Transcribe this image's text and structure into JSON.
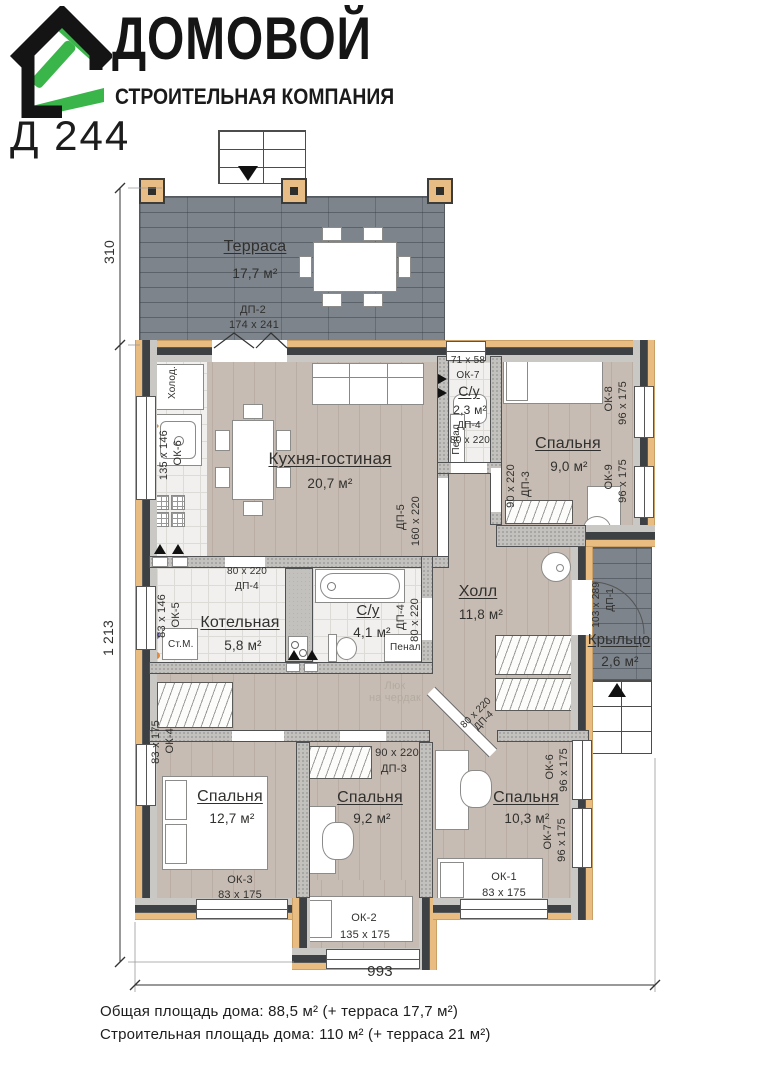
{
  "header": {
    "brand": "ДОМОВОЙ",
    "subtitle": "СТРОИТЕЛЬНАЯ КОМПАНИЯ",
    "model": "Д 244"
  },
  "colors": {
    "logo_green": "#3ab54a",
    "wall_dark": "#3e4144",
    "insulation": "#e9bd82",
    "terrace_tile": "#7d848c",
    "wood_floor": "#c7bcb3"
  },
  "dimensions": {
    "terrace_depth": "310",
    "house_depth": "1 213",
    "house_width": "993"
  },
  "rooms": {
    "terrace": {
      "name": "Терраса",
      "area": "17,7 м²"
    },
    "kitchen": {
      "name": "Кухня-гостиная",
      "area": "20,7 м²"
    },
    "wc": {
      "name": "С/у",
      "area": "2,3 м²"
    },
    "bedroom_tr": {
      "name": "Спальня",
      "area": "9,0 м²"
    },
    "boiler": {
      "name": "Котельная",
      "area": "5,8 м²"
    },
    "bath": {
      "name": "С/у",
      "area": "4,1 м²"
    },
    "hall": {
      "name": "Холл",
      "area": "11,8 м²"
    },
    "porch": {
      "name": "Крыльцо",
      "area": "2,6 м²"
    },
    "bedroom_bl": {
      "name": "Спальня",
      "area": "12,7 м²"
    },
    "bedroom_bm": {
      "name": "Спальня",
      "area": "9,2 м²"
    },
    "bedroom_br": {
      "name": "Спальня",
      "area": "10,3 м²"
    }
  },
  "openings": {
    "dp2": {
      "id": "ДП-2",
      "size": "174 х 241"
    },
    "dp5": {
      "id": "ДП-5",
      "size": "160 х 220"
    },
    "dp4_wc": {
      "id": "ДП-4",
      "size": "80 х 220"
    },
    "dp4_boiler": {
      "id": "ДП-4",
      "size": "80 х 220"
    },
    "dp4_bath": {
      "id": "ДП-4",
      "size": "80 х 220"
    },
    "dp4_br": {
      "id": "ДП-4",
      "size": "80 х 220"
    },
    "dp3_tr": {
      "id": "ДП-3",
      "size": "90 х 220"
    },
    "dp3_bm": {
      "id": "ДП-3",
      "size": "90 х 220"
    },
    "dp1": {
      "id": "ДП-1",
      "size": "103 х 289"
    },
    "ok7_wc": {
      "id": "ОК-7",
      "size": "71 х 58"
    },
    "ok6_k": {
      "id": "ОК-6",
      "size": "135 х 146"
    },
    "ok5": {
      "id": "ОК-5",
      "size": "83 х 146"
    },
    "ok4": {
      "id": "ОК-4",
      "size": "83 х 175"
    },
    "ok3": {
      "id": "ОК-3",
      "size": "83 х 175"
    },
    "ok2": {
      "id": "ОК-2",
      "size": "135 х 175"
    },
    "ok1": {
      "id": "ОК-1",
      "size": "83 х 175"
    },
    "ok8": {
      "id": "ОК-8",
      "size": "96 х 175"
    },
    "ok9": {
      "id": "ОК-9",
      "size": "96 х 175"
    },
    "ok6_br": {
      "id": "ОК-6",
      "size": "96 х 175"
    },
    "ok7_br": {
      "id": "ОК-7",
      "size": "96 х 175"
    }
  },
  "fixtures": {
    "fridge": "Холод.",
    "washer": "Ст.М.",
    "cabinet_wc": "Пенал",
    "cabinet_bath": "Пенал",
    "attic_line1": "Люк",
    "attic_line2": "на чердак"
  },
  "footer": {
    "line1": "Общая площадь дома: 88,5 м² (+ терраса 17,7 м²)",
    "line2": "Строительная площадь дома: 110 м² (+ терраса 21 м²)"
  }
}
